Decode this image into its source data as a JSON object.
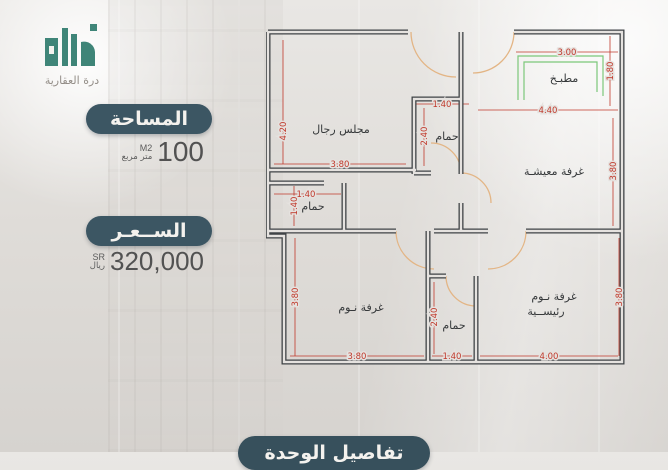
{
  "brand": {
    "name": "درة العقارية"
  },
  "area": {
    "banner": "المساحة",
    "value": "100",
    "unit_top": "M2",
    "unit_bottom": "متر مربع"
  },
  "price": {
    "banner": "الســعـر",
    "value": "320,000",
    "unit_top": "SR",
    "unit_bottom": "ريال"
  },
  "footer": {
    "banner": "تفاصيل الوحدة"
  },
  "plan": {
    "rooms": {
      "majlis": "مجلس رجال",
      "bath_top": "حمام",
      "kitchen": "مطبـخ",
      "living": "غرفة معيشـة",
      "bath_mid": "حمام",
      "bedroom": "غرفة نـوم",
      "bath_bottom": "حمام",
      "master1": "غرفة نـوم",
      "master2": "رئيســية"
    },
    "dims": {
      "majlis_h": "4.20",
      "majlis_w": "3.80",
      "bath_top_w": "1.40",
      "bath_top_h": "2.40",
      "kitchen_w": "3.00",
      "kitchen_d": "1.80",
      "living_w": "4.40",
      "living_h": "3.80",
      "bath_mid_w": "1.40",
      "bath_mid_h": "1.40",
      "bedroom_h": "3.80",
      "bedroom_w": "3.80",
      "bath_bot_h": "2.40",
      "bath_bot_w": "1.40",
      "master_h": "3.80",
      "master_w": "4.00"
    },
    "colors": {
      "wall": "#3f4346",
      "dimension": "#c0392b",
      "door": "#e3b585",
      "counter": "#7cc87a"
    }
  },
  "theme": {
    "pill_bg": "#3c5663",
    "pill_text": "#f4f2ee",
    "logo_teal": "#3f8578",
    "value_color": "#525252"
  }
}
